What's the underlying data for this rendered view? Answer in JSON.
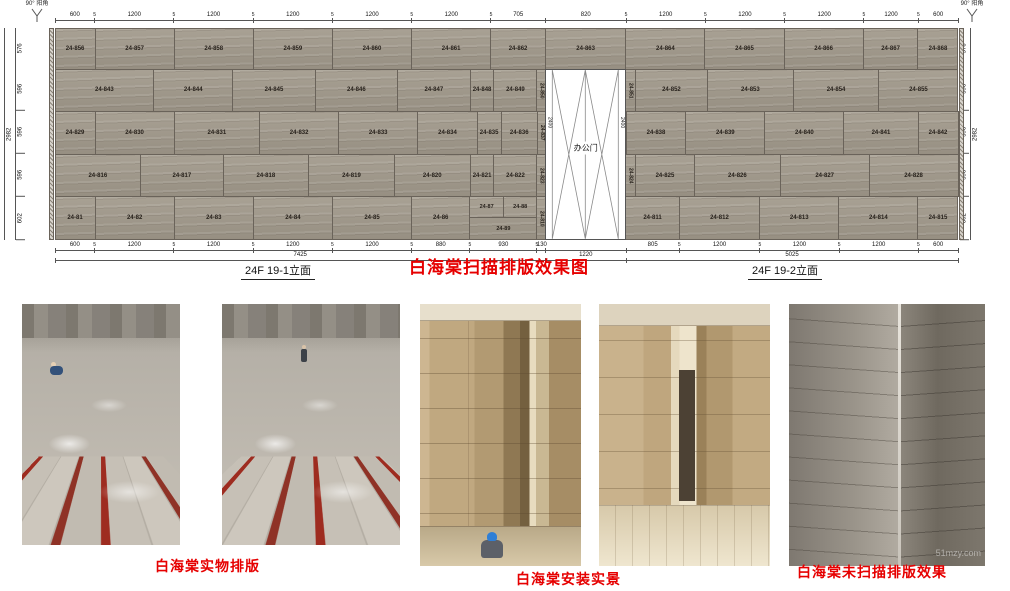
{
  "corner_mark": "90° 阳角",
  "title": "白海棠扫描排版效果图",
  "elevation_left_label": "24F 19-1立面",
  "elevation_right_label": "24F 19-2立面",
  "door": {
    "label": "办公门",
    "height_dim": "2400"
  },
  "captions": {
    "layout": "白海棠实物排版",
    "install": "白海棠安装实景",
    "unscanned": "白海棠未扫描排版效果"
  },
  "watermark": "51mzy.com",
  "colors": {
    "accent_red": "#e60000",
    "stone": "#a29a8c",
    "line": "#555555"
  },
  "dims": {
    "top": [
      {
        "t": "600",
        "w": 600
      },
      {
        "t": "5",
        "w": 0
      },
      {
        "t": "1200",
        "w": 1200
      },
      {
        "t": "5",
        "w": 0
      },
      {
        "t": "1200",
        "w": 1200
      },
      {
        "t": "5",
        "w": 0
      },
      {
        "t": "1200",
        "w": 1200
      },
      {
        "t": "5",
        "w": 0
      },
      {
        "t": "1200",
        "w": 1200
      },
      {
        "t": "5",
        "w": 0
      },
      {
        "t": "1200",
        "w": 1200
      },
      {
        "t": "5",
        "w": 0
      },
      {
        "t": "705",
        "w": 825
      },
      {
        "t": "820",
        "w": 1220
      },
      {
        "t": "5",
        "w": 0
      },
      {
        "t": "1200",
        "w": 1200
      },
      {
        "t": "5",
        "w": 0
      },
      {
        "t": "1200",
        "w": 1200
      },
      {
        "t": "5",
        "w": 0
      },
      {
        "t": "1200",
        "w": 1200
      },
      {
        "t": "5",
        "w": 0
      },
      {
        "t": "1200",
        "w": 825
      },
      {
        "t": "5",
        "w": 0
      },
      {
        "t": "600",
        "w": 600
      }
    ],
    "bottom": [
      {
        "t": "600",
        "w": 600
      },
      {
        "t": "5",
        "w": 0
      },
      {
        "t": "1200",
        "w": 1200
      },
      {
        "t": "5",
        "w": 0
      },
      {
        "t": "1200",
        "w": 1200
      },
      {
        "t": "5",
        "w": 0
      },
      {
        "t": "1200",
        "w": 1200
      },
      {
        "t": "5",
        "w": 0
      },
      {
        "t": "1200",
        "w": 1200
      },
      {
        "t": "5",
        "w": 0
      },
      {
        "t": "880",
        "w": 880
      },
      {
        "t": "5",
        "w": 0
      },
      {
        "t": "930",
        "w": 1015
      },
      {
        "t": "5",
        "w": 0
      },
      {
        "t": "130",
        "w": 130
      },
      {
        "t": "",
        "w": 1220
      },
      {
        "t": "805",
        "w": 805
      },
      {
        "t": "5",
        "w": 0
      },
      {
        "t": "1200",
        "w": 1220
      },
      {
        "t": "5",
        "w": 0
      },
      {
        "t": "1200",
        "w": 1200
      },
      {
        "t": "5",
        "w": 0
      },
      {
        "t": "1200",
        "w": 1200
      },
      {
        "t": "5",
        "w": 0
      },
      {
        "t": "600",
        "w": 600
      }
    ],
    "totals": [
      {
        "t": "7425",
        "w": 7425
      },
      {
        "t": "1220",
        "w": 1220
      },
      {
        "t": "5025",
        "w": 5025
      }
    ],
    "side_rows": [
      {
        "t": "576",
        "w": 576
      },
      {
        "t": "596",
        "w": 596
      },
      {
        "t": "596",
        "w": 596
      },
      {
        "t": "596",
        "w": 596
      },
      {
        "t": "602",
        "w": 602
      }
    ],
    "side_total": "2982"
  },
  "elevation": {
    "rows": [
      {
        "h": 576,
        "panels": [
          {
            "n": "24-856",
            "w": 600
          },
          {
            "n": "24-857",
            "w": 1200
          },
          {
            "n": "24-858",
            "w": 1200
          },
          {
            "n": "24-859",
            "w": 1200
          },
          {
            "n": "24-860",
            "w": 1200
          },
          {
            "n": "24-861",
            "w": 1200
          },
          {
            "n": "24-862",
            "w": 825
          },
          {
            "n": "24-863",
            "w": 1220
          },
          {
            "n": "24-864",
            "w": 1200
          },
          {
            "n": "24-865",
            "w": 1200
          },
          {
            "n": "24-866",
            "w": 1200
          },
          {
            "n": "24-867",
            "w": 825
          },
          {
            "n": "24-868",
            "w": 600
          }
        ]
      },
      {
        "h": 596,
        "panels": [
          {
            "n": "24-843",
            "w": 1500
          },
          {
            "n": "24-844",
            "w": 1200
          },
          {
            "n": "24-845",
            "w": 1250
          },
          {
            "n": "24-846",
            "w": 1250
          },
          {
            "n": "24-847",
            "w": 1100
          },
          {
            "n": "24-848",
            "w": 350
          },
          {
            "n": "24-849",
            "w": 645
          },
          {
            "n": "24-850",
            "w": 130,
            "v": true
          },
          {
            "door": true,
            "w": 1220
          },
          {
            "n": "24-851",
            "w": 130,
            "v": true
          },
          {
            "n": "24-852",
            "w": 1095
          },
          {
            "n": "24-853",
            "w": 1300
          },
          {
            "n": "24-854",
            "w": 1300
          },
          {
            "n": "24-855",
            "w": 1200
          }
        ]
      },
      {
        "h": 596,
        "panels": [
          {
            "n": "24-829",
            "w": 600
          },
          {
            "n": "24-830",
            "w": 1200
          },
          {
            "n": "24-831",
            "w": 1300
          },
          {
            "n": "24-832",
            "w": 1200
          },
          {
            "n": "24-833",
            "w": 1200
          },
          {
            "n": "24-834",
            "w": 900
          },
          {
            "n": "24-835",
            "w": 350
          },
          {
            "n": "24-836",
            "w": 545
          },
          {
            "n": "24-837",
            "w": 130,
            "v": true
          },
          {
            "door": true,
            "w": 1220
          },
          {
            "n": "24-838",
            "w": 900
          },
          {
            "n": "24-839",
            "w": 1200
          },
          {
            "n": "24-840",
            "w": 1200
          },
          {
            "n": "24-841",
            "w": 1125
          },
          {
            "n": "24-842",
            "w": 600
          }
        ]
      },
      {
        "h": 596,
        "panels": [
          {
            "n": "24-816",
            "w": 1300
          },
          {
            "n": "24-817",
            "w": 1250
          },
          {
            "n": "24-818",
            "w": 1300
          },
          {
            "n": "24-819",
            "w": 1300
          },
          {
            "n": "24-820",
            "w": 1150
          },
          {
            "n": "24-821",
            "w": 350
          },
          {
            "n": "24-822",
            "w": 645
          },
          {
            "n": "24-823",
            "w": 130,
            "v": true
          },
          {
            "door": true,
            "w": 1220
          },
          {
            "n": "24-824",
            "w": 130,
            "v": true
          },
          {
            "n": "24-825",
            "w": 895
          },
          {
            "n": "24-826",
            "w": 1300
          },
          {
            "n": "24-827",
            "w": 1350
          },
          {
            "n": "24-828",
            "w": 1350
          }
        ]
      },
      {
        "h": 602,
        "panels": [
          {
            "n": "24-81",
            "w": 600
          },
          {
            "n": "24-82",
            "w": 1200
          },
          {
            "n": "24-83",
            "w": 1200
          },
          {
            "n": "24-84",
            "w": 1200
          },
          {
            "n": "24-85",
            "w": 1200
          },
          {
            "n": "24-86",
            "w": 880
          },
          {
            "split": {
              "top": [
                "24-87",
                "24-88"
              ],
              "bottom": "24-89"
            },
            "w": 1015
          },
          {
            "n": "24-810",
            "w": 130,
            "v": true
          },
          {
            "door": true,
            "w": 1220
          },
          {
            "n": "24-811",
            "w": 805
          },
          {
            "n": "24-812",
            "w": 1220
          },
          {
            "n": "24-813",
            "w": 1200
          },
          {
            "n": "24-814",
            "w": 1200
          },
          {
            "n": "24-815",
            "w": 600
          }
        ]
      }
    ]
  }
}
